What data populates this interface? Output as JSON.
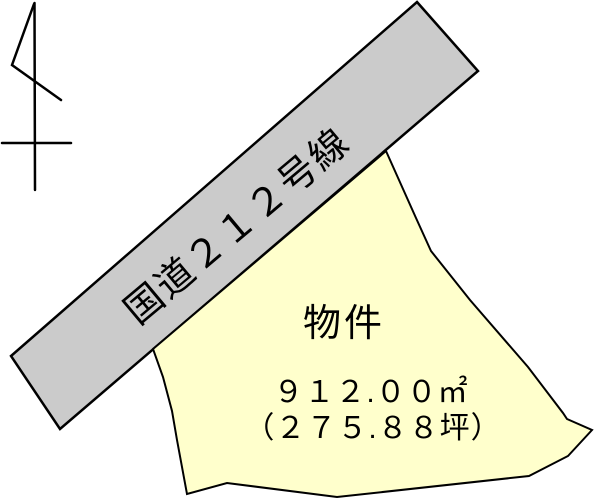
{
  "figure": {
    "type": "land-plot-diagram",
    "background_color": "#ffffff",
    "outline_color": "#000000"
  },
  "north_arrow": {
    "icon": "north-arrow-icon"
  },
  "road": {
    "label": "国道２１２号線",
    "fill_color": "#cbcbcb"
  },
  "parcel": {
    "label": "物件",
    "area_m2": "９１２.００㎡",
    "area_tsubo": "（２７５.８８坪）",
    "fill_color": "#ffffcc"
  }
}
